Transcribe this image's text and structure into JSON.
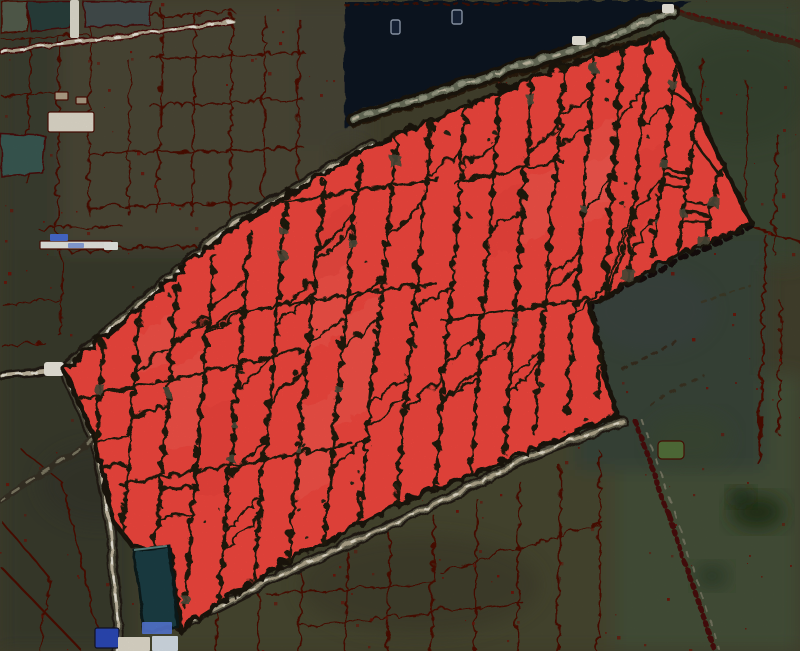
{
  "canvas": {
    "w": 800,
    "h": 651
  },
  "colors": {
    "base": "#45432f",
    "red_fill": "#f94a41",
    "red_light": "#ff7a6d",
    "red_deep": "#d92e26",
    "divider": "#201b10",
    "red_border": "#1d160d",
    "edge_red": "#4e0d06",
    "edge_red_bright": "#6e150a",
    "water": "#0e1524",
    "shore": "#55604f",
    "pond_teal": "#2b403c",
    "pond_teal2": "#3a5c55",
    "pond_gray": "#454f4f",
    "pond_dark": "#1d3f46",
    "pond_dark_edge": "#0d1a1f",
    "pond_dark_hi": "#5d8682",
    "road_casing": "#241c12",
    "road_band": "#54523f",
    "road_tan": "#c9bfa8",
    "road_white": "#f4f1e6",
    "road_gray": "#6b705c",
    "road_gray_hi": "#9a9d86",
    "band_gray": "#4e4d3b",
    "dot_dark": "#2c2516",
    "blue_bldg": "#2c4bbd",
    "blue_bldg2": "#5b7ee0",
    "blue_bldg3": "#7e9ae2",
    "white_bldg": "#e9e3d4",
    "grass_green": "#55743c",
    "boat_fill": "#18243a",
    "boat_stroke": "#96a2b4"
  },
  "patches": [
    {
      "x": 0,
      "y": 0,
      "w": 95,
      "h": 265,
      "fill": "#3d4030",
      "op": 1
    },
    {
      "x": 60,
      "y": 0,
      "w": 275,
      "h": 260,
      "fill": "#4e4937",
      "op": 1
    },
    {
      "x": 295,
      "y": 0,
      "w": 70,
      "h": 145,
      "fill": "#4a4738",
      "op": 1
    },
    {
      "x": 0,
      "y": 250,
      "w": 210,
      "h": 205,
      "fill": "#3a3c2d",
      "op": 1
    },
    {
      "x": 0,
      "y": 425,
      "w": 135,
      "h": 226,
      "fill": "#3a3d2e",
      "op": 1
    },
    {
      "x": 140,
      "y": 430,
      "w": 510,
      "h": 221,
      "fill": "#4a4833",
      "op": 1
    },
    {
      "x": 615,
      "y": 375,
      "w": 185,
      "h": 276,
      "fill": "#46523a",
      "op": 1
    },
    {
      "x": 650,
      "y": 0,
      "w": 150,
      "h": 265,
      "fill": "#3e4a35",
      "op": 1
    },
    {
      "x": 575,
      "y": 235,
      "w": 190,
      "h": 235,
      "fill": "#3a463b",
      "op": 1
    }
  ],
  "mottles": [
    {
      "cx": 757,
      "cy": 512,
      "rx": 27,
      "ry": 17,
      "fill": "#243019",
      "op": 0.95
    },
    {
      "cx": 741,
      "cy": 497,
      "rx": 12,
      "ry": 9,
      "fill": "#1d2a16",
      "op": 0.9
    },
    {
      "cx": 712,
      "cy": 576,
      "rx": 17,
      "ry": 12,
      "fill": "#2c3a26",
      "op": 0.8
    },
    {
      "cx": 650,
      "cy": 310,
      "rx": 62,
      "ry": 40,
      "fill": "#3f4450",
      "op": 0.33
    },
    {
      "cx": 740,
      "cy": 90,
      "rx": 70,
      "ry": 55,
      "fill": "#36432f",
      "op": 0.5
    },
    {
      "cx": 240,
      "cy": 330,
      "rx": 70,
      "ry": 45,
      "fill": "#30332a",
      "op": 0.4
    },
    {
      "cx": 420,
      "cy": 585,
      "rx": 120,
      "ry": 50,
      "fill": "#3c3b29",
      "op": 0.5
    },
    {
      "cx": 100,
      "cy": 485,
      "rx": 60,
      "ry": 40,
      "fill": "#34362a",
      "op": 0.5
    },
    {
      "cx": 690,
      "cy": 440,
      "rx": 40,
      "ry": 26,
      "fill": "#3e4c33",
      "op": 0.6
    }
  ],
  "bg_lines": [
    [
      88,
      20,
      86,
      212,
      1.6
    ],
    [
      160,
      8,
      156,
      212,
      1.6
    ],
    [
      193,
      10,
      190,
      214,
      1.6
    ],
    [
      230,
      12,
      228,
      216,
      1.6
    ],
    [
      263,
      14,
      261,
      218,
      1.6
    ],
    [
      297,
      17,
      295,
      222,
      1.6
    ],
    [
      128,
      60,
      126,
      212,
      1.4
    ],
    [
      85,
      18,
      232,
      10,
      1.6
    ],
    [
      148,
      56,
      302,
      50,
      1.6
    ],
    [
      148,
      104,
      302,
      98,
      1.6
    ],
    [
      86,
      152,
      302,
      146,
      1.8
    ],
    [
      86,
      205,
      302,
      199,
      1.8
    ],
    [
      0,
      37,
      86,
      32,
      1.6
    ],
    [
      0,
      94,
      56,
      90,
      1.4
    ],
    [
      28,
      36,
      26,
      182,
      1.6
    ],
    [
      57,
      36,
      55,
      232,
      1.6
    ],
    [
      58,
      250,
      300,
      240,
      1.8
    ],
    [
      60,
      252,
      58,
      334,
      1.5
    ],
    [
      0,
      302,
      58,
      298,
      1.5
    ],
    [
      0,
      344,
      42,
      340,
      1.4
    ],
    [
      38,
      228,
      120,
      224,
      1.4
    ],
    [
      0,
      520,
      48,
      576,
      1.8
    ],
    [
      0,
      566,
      82,
      651,
      2.2
    ],
    [
      48,
      576,
      38,
      651,
      1.6
    ],
    [
      22,
      450,
      60,
      480,
      1.5
    ],
    [
      60,
      480,
      98,
      640,
      1.8
    ],
    [
      215,
      600,
      213,
      651,
      1.8
    ],
    [
      258,
      587,
      255,
      651,
      1.8
    ],
    [
      300,
      567,
      298,
      651,
      1.8
    ],
    [
      345,
      550,
      342,
      651,
      1.8
    ],
    [
      388,
      532,
      385,
      651,
      1.8
    ],
    [
      432,
      514,
      429,
      651,
      1.8
    ],
    [
      475,
      497,
      472,
      651,
      1.8
    ],
    [
      518,
      480,
      515,
      651,
      1.8
    ],
    [
      558,
      464,
      556,
      651,
      1.8
    ],
    [
      598,
      450,
      596,
      651,
      1.8
    ],
    [
      265,
      592,
      430,
      581,
      1.6
    ],
    [
      438,
      570,
      600,
      520,
      1.5
    ],
    [
      300,
      625,
      520,
      600,
      1.4
    ],
    [
      763,
      233,
      757,
      462,
      2.2
    ],
    [
      779,
      300,
      776,
      432,
      1.6
    ],
    [
      750,
      226,
      800,
      240,
      2
    ],
    [
      745,
      80,
      742,
      212,
      1.6
    ],
    [
      775,
      132,
      772,
      252,
      1.5
    ],
    [
      700,
      56,
      697,
      130,
      1.4
    ]
  ],
  "speckles": {
    "count": 300,
    "seed": 11,
    "min": 1,
    "max": 3.5
  },
  "water": {
    "points": "343,0 690,0 668,12 584,40 352,116 344,128",
    "boats": [
      {
        "x": 391,
        "y": 20,
        "w": 9,
        "h": 14
      },
      {
        "x": 452,
        "y": 10,
        "w": 10,
        "h": 14
      }
    ]
  },
  "ponds": [
    {
      "points": "0,0 28,0 26,30 0,32",
      "fill": "#57614f",
      "stroke": "#4e0d06"
    },
    {
      "points": "26,0 72,0 68,26 30,30",
      "fill": "#2b403c",
      "stroke": "#4a0d08"
    },
    {
      "points": "82,0 150,0 148,24 84,26",
      "fill": "#454f4f",
      "stroke": "#4a0d08"
    },
    {
      "points": "0,133 44,135 41,172 0,175",
      "fill": "#3a5c55",
      "stroke": "#4a0d08"
    }
  ],
  "dash_lines": [
    {
      "x1": 343,
      "y1": 3,
      "x2": 545,
      "y2": 3,
      "s": "#4a0d08",
      "w": 2,
      "dash": "4 6",
      "op": 0.8
    },
    {
      "x1": 352,
      "y1": 112,
      "x2": 584,
      "y2": 40,
      "s": "#55604f",
      "w": 3,
      "dash": "3 8",
      "op": 0.9
    },
    {
      "x1": 584,
      "y1": 40,
      "x2": 650,
      "y2": 14,
      "s": "#55604f",
      "w": 3,
      "dash": "3 8",
      "op": 0.9
    },
    {
      "x1": 352,
      "y1": 124,
      "x2": 584,
      "y2": 52,
      "s": "#2a1c0e",
      "w": 5,
      "dash": "6 5",
      "op": 1
    },
    {
      "x1": 584,
      "y1": 52,
      "x2": 660,
      "y2": 34,
      "s": "#2a1c0e",
      "w": 5,
      "dash": "6 5",
      "op": 1
    },
    {
      "x1": 672,
      "y1": 10,
      "x2": 800,
      "y2": 44,
      "s": "#3c2c1a",
      "w": 6,
      "dash": "7 4",
      "op": 1
    },
    {
      "x1": 672,
      "y1": 8,
      "x2": 800,
      "y2": 40,
      "s": "#5c1009",
      "w": 2.5,
      "dash": "3 4",
      "op": 0.9
    },
    {
      "x1": 622,
      "y1": 368,
      "x2": 678,
      "y2": 338,
      "s": "#3a2817",
      "w": 3,
      "dash": "4 7",
      "op": 0.8
    },
    {
      "x1": 650,
      "y1": 404,
      "x2": 702,
      "y2": 374,
      "s": "#3a2817",
      "w": 2.5,
      "dash": "4 8",
      "op": 0.6
    },
    {
      "x1": 700,
      "y1": 300,
      "x2": 748,
      "y2": 284,
      "s": "#44301c",
      "w": 2.5,
      "dash": "4 6",
      "op": 0.5
    },
    {
      "x1": 750,
      "y1": 224,
      "x2": 590,
      "y2": 302,
      "s": "#18100a",
      "w": 6,
      "dash": "5 7",
      "op": 1
    },
    {
      "x1": 590,
      "y1": 302,
      "x2": 606,
      "y2": 386,
      "s": "#18100a",
      "w": 6,
      "dash": "5 7",
      "op": 1
    },
    {
      "x1": 606,
      "y1": 386,
      "x2": 616,
      "y2": 412,
      "s": "#18100a",
      "w": 6,
      "dash": "5 7",
      "op": 1
    },
    {
      "x1": 634,
      "y1": 420,
      "x2": 668,
      "y2": 515,
      "s": "#4a0e07",
      "w": 5,
      "dash": "3 5",
      "op": 1
    },
    {
      "x1": 640,
      "y1": 418,
      "x2": 674,
      "y2": 512,
      "s": "#8a8672",
      "w": 2,
      "dash": "5 9",
      "op": 0.8
    },
    {
      "x1": 668,
      "y1": 515,
      "x2": 714,
      "y2": 651,
      "s": "#4a0e07",
      "w": 5,
      "dash": "3 5",
      "op": 1
    },
    {
      "x1": 674,
      "y1": 512,
      "x2": 718,
      "y2": 648,
      "s": "#8a8672",
      "w": 2,
      "dash": "5 9",
      "op": 0.7
    }
  ],
  "roads": [
    {
      "name": "road-top-path",
      "d": "M0,50 L140,33 L232,20",
      "layers": [
        {
          "s": "#4a0d08",
          "w": 6,
          "dash": "5 4"
        },
        {
          "s": "#bdb29a",
          "w": 3
        },
        {
          "s": "#f4f1e6",
          "w": 2,
          "dash": "5 14"
        }
      ]
    },
    {
      "name": "road-main-sw",
      "d": "M62,368 L230,225 L370,143",
      "layers": [
        {
          "s": "#241c12",
          "w": 13
        },
        {
          "s": "#54523f",
          "w": 8
        },
        {
          "s": "#c9bfa8",
          "w": 3.2
        },
        {
          "s": "#f4f1e6",
          "w": 2,
          "dash": "7 22"
        }
      ]
    },
    {
      "name": "road-waterside",
      "d": "M352,118 L584,44 L672,10",
      "layers": [
        {
          "s": "#1c150e",
          "w": 14
        },
        {
          "s": "#6b705c",
          "w": 7
        },
        {
          "s": "#9a9d86",
          "w": 4,
          "dash": "5 9"
        },
        {
          "s": "#cdc4ad",
          "w": 2,
          "dash": "6 24",
          "op": 0.9
        }
      ]
    },
    {
      "name": "road-west-vertical",
      "d": "M62,368 L93,438 L109,523 L118,642 L115,651",
      "layers": [
        {
          "s": "#241c12",
          "w": 11
        },
        {
          "s": "#4f4d3d",
          "w": 7
        },
        {
          "s": "#c9bfa8",
          "w": 3
        },
        {
          "s": "#f4f1e6",
          "w": 2,
          "dash": "6 12"
        }
      ]
    },
    {
      "name": "road-west-stub",
      "d": "M0,374 L62,368",
      "layers": [
        {
          "s": "#241c12",
          "w": 9
        },
        {
          "s": "#c9bfa8",
          "w": 3.5
        },
        {
          "s": "#f4f1e6",
          "w": 2,
          "dash": "5 10"
        }
      ]
    },
    {
      "name": "track-southwest",
      "d": "M93,438 L0,499",
      "layers": [
        {
          "s": "#383226",
          "w": 7
        },
        {
          "s": "#8d8872",
          "w": 2.5,
          "dash": "8 10",
          "op": 0.85
        }
      ]
    },
    {
      "name": "road-southeast",
      "d": "M178,625 L266,580 L430,505 L529,455 L622,420",
      "layers": [
        {
          "s": "#241c12",
          "w": 11
        },
        {
          "s": "#5d5a48",
          "w": 6.5
        },
        {
          "s": "#b5ab90",
          "w": 3
        },
        {
          "s": "#ece6d4",
          "w": 1.8,
          "dash": "4 12"
        }
      ]
    }
  ],
  "blobs": [
    {
      "x": 70,
      "y": 0,
      "w": 9,
      "h": 38,
      "fill": "#e8e4d6",
      "rx": 2
    },
    {
      "x": 48,
      "y": 112,
      "w": 46,
      "h": 20,
      "fill": "#e9e3d4",
      "rx": 2,
      "sd": "#4c1006"
    },
    {
      "x": 55,
      "y": 92,
      "w": 13,
      "h": 8,
      "fill": "#b8a88e",
      "rx": 1,
      "sd": "#4c1006"
    },
    {
      "x": 76,
      "y": 97,
      "w": 11,
      "h": 7,
      "fill": "#b0a189",
      "rx": 1,
      "sd": "#4c1006"
    },
    {
      "x": 40,
      "y": 241,
      "w": 72,
      "h": 8,
      "fill": "#eef0ea",
      "rx": 1,
      "sd": "#4c1006"
    },
    {
      "x": 50,
      "y": 234,
      "w": 18,
      "h": 7,
      "fill": "#4a6fd8",
      "rx": 1
    },
    {
      "x": 68,
      "y": 243,
      "w": 16,
      "h": 5,
      "fill": "#7e9ae2",
      "rx": 1,
      "op": 0.85
    },
    {
      "x": 104,
      "y": 242,
      "w": 14,
      "h": 8,
      "fill": "#f2f4ee",
      "rx": 1
    },
    {
      "x": 44,
      "y": 362,
      "w": 20,
      "h": 14,
      "fill": "#f4f1e6",
      "rx": 3
    },
    {
      "x": 572,
      "y": 36,
      "w": 14,
      "h": 9,
      "fill": "#f4f1e6",
      "rx": 2
    },
    {
      "x": 662,
      "y": 4,
      "w": 12,
      "h": 9,
      "fill": "#f4f1e6",
      "rx": 2
    },
    {
      "x": 658,
      "y": 441,
      "w": 26,
      "h": 18,
      "fill": "#55743c",
      "rx": 4,
      "sd": "#4c1006"
    }
  ],
  "red_region": {
    "points": "62,368 230,225 370,143 460,105 530,77 600,50 662,32 700,118 750,222 675,252 588,302 606,386 616,412 520,452 400,500 300,552 266,570 196,615 178,629 169,549 131,545 112,521 93,438",
    "verticals": [
      [
        100,
        340,
        88,
        540
      ],
      [
        138,
        308,
        118,
        562
      ],
      [
        175,
        280,
        150,
        585
      ],
      [
        212,
        252,
        182,
        605
      ],
      [
        248,
        228,
        215,
        615
      ],
      [
        285,
        202,
        250,
        592
      ],
      [
        322,
        178,
        285,
        572
      ],
      [
        358,
        158,
        320,
        552
      ],
      [
        395,
        135,
        355,
        532
      ],
      [
        430,
        114,
        393,
        512
      ],
      [
        465,
        98,
        432,
        492
      ],
      [
        498,
        86,
        468,
        472
      ],
      [
        530,
        78,
        502,
        452
      ],
      [
        562,
        66,
        532,
        432
      ],
      [
        592,
        56,
        565,
        412
      ],
      [
        620,
        45,
        595,
        392
      ],
      [
        648,
        34,
        622,
        306
      ],
      [
        675,
        44,
        650,
        256
      ],
      [
        700,
        78,
        674,
        252
      ],
      [
        726,
        140,
        698,
        250
      ]
    ],
    "crosses": [
      [
        70,
        398,
        300,
        348
      ],
      [
        230,
        310,
        432,
        280
      ],
      [
        238,
        206,
        436,
        176
      ],
      [
        440,
        318,
        586,
        296
      ],
      [
        118,
        482,
        350,
        442
      ],
      [
        452,
        180,
        560,
        158
      ]
    ],
    "seed": 13,
    "dots": 95,
    "patch_count": 26,
    "light_count": 12
  },
  "after_red": {
    "pond": {
      "points": "133,549 168,545 176,625 143,631",
      "fill": "#1d3f46",
      "stroke": "#0d1a1f",
      "hi": {
        "x1": 134,
        "y1": 550,
        "x2": 167,
        "y2": 546,
        "s": "#5d8682",
        "w": 2
      }
    },
    "blobs": [
      {
        "x": 95,
        "y": 628,
        "w": 24,
        "h": 20,
        "fill": "#2c4bbd",
        "rx": 2,
        "sd": "#141428"
      },
      {
        "x": 118,
        "y": 637,
        "w": 32,
        "h": 14,
        "fill": "#e9e3d4",
        "rx": 1
      },
      {
        "x": 142,
        "y": 622,
        "w": 30,
        "h": 12,
        "fill": "#5b7ee0",
        "rx": 1,
        "op": 0.9
      },
      {
        "x": 152,
        "y": 636,
        "w": 26,
        "h": 15,
        "fill": "#dce7f0",
        "rx": 1
      }
    ]
  },
  "grain_opacity": 0.11
}
